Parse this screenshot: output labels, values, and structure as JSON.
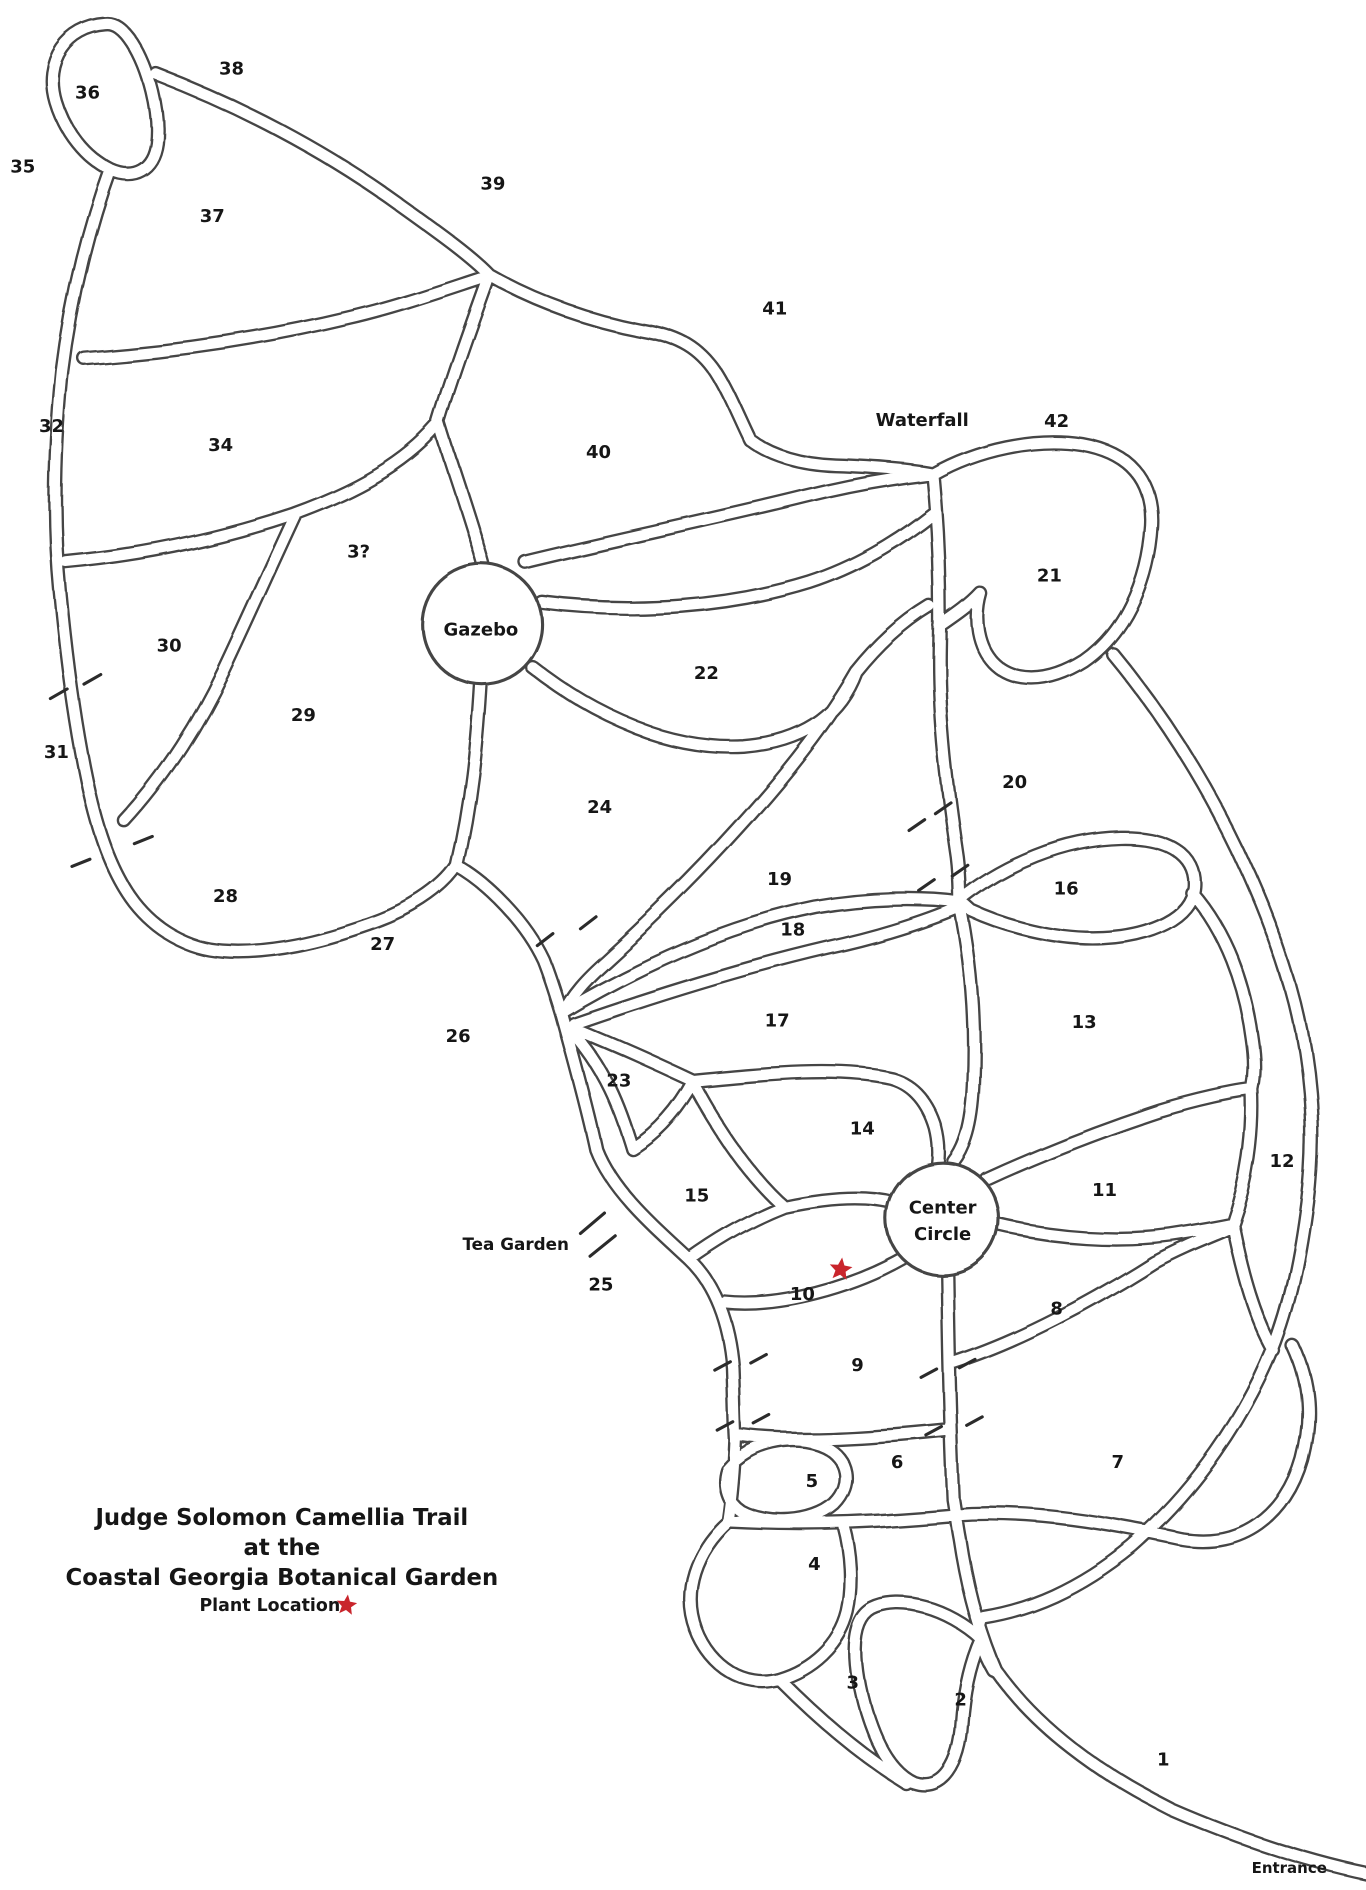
{
  "map": {
    "title_lines": [
      "Judge Solomon Camellia Trail",
      "at the",
      "Coastal Georgia Botanical Garden"
    ],
    "legend": {
      "label": "Plant Location"
    },
    "colors": {
      "ink": "#454545",
      "text": "#161616",
      "star": "#c9252c"
    },
    "regions": [
      {
        "number": "1",
        "x": 970,
        "y": 1467
      },
      {
        "number": "2",
        "x": 801,
        "y": 1417
      },
      {
        "number": "3",
        "x": 711,
        "y": 1403
      },
      {
        "number": "4",
        "x": 679,
        "y": 1304
      },
      {
        "number": "5",
        "x": 677,
        "y": 1235
      },
      {
        "number": "6",
        "x": 748,
        "y": 1219
      },
      {
        "number": "7",
        "x": 932,
        "y": 1219
      },
      {
        "number": "8",
        "x": 881,
        "y": 1091
      },
      {
        "number": "9",
        "x": 715,
        "y": 1138
      },
      {
        "number": "10",
        "x": 669,
        "y": 1079
      },
      {
        "number": "11",
        "x": 921,
        "y": 992
      },
      {
        "number": "12",
        "x": 1069,
        "y": 968
      },
      {
        "number": "13",
        "x": 904,
        "y": 852
      },
      {
        "number": "14",
        "x": 719,
        "y": 941
      },
      {
        "number": "15",
        "x": 581,
        "y": 997
      },
      {
        "number": "16",
        "x": 889,
        "y": 741
      },
      {
        "number": "17",
        "x": 648,
        "y": 851
      },
      {
        "number": "18",
        "x": 661,
        "y": 775
      },
      {
        "number": "19",
        "x": 650,
        "y": 733
      },
      {
        "number": "20",
        "x": 846,
        "y": 652
      },
      {
        "number": "21",
        "x": 875,
        "y": 480
      },
      {
        "number": "22",
        "x": 589,
        "y": 561
      },
      {
        "number": "23",
        "x": 516,
        "y": 901
      },
      {
        "number": "24",
        "x": 500,
        "y": 673
      },
      {
        "number": "25",
        "x": 501,
        "y": 1071
      },
      {
        "number": "26",
        "x": 382,
        "y": 864
      },
      {
        "number": "27",
        "x": 319,
        "y": 787
      },
      {
        "number": "28",
        "x": 188,
        "y": 747
      },
      {
        "number": "29",
        "x": 253,
        "y": 596
      },
      {
        "number": "30",
        "x": 141,
        "y": 538
      },
      {
        "number": "31",
        "x": 47,
        "y": 627
      },
      {
        "number": "32",
        "x": 43,
        "y": 355
      },
      {
        "number": "3?",
        "x": 299,
        "y": 460
      },
      {
        "number": "34",
        "x": 184,
        "y": 371
      },
      {
        "number": "35",
        "x": 19,
        "y": 139
      },
      {
        "number": "36",
        "x": 73,
        "y": 77
      },
      {
        "number": "37",
        "x": 177,
        "y": 180
      },
      {
        "number": "38",
        "x": 193,
        "y": 57
      },
      {
        "number": "39",
        "x": 411,
        "y": 153
      },
      {
        "number": "40",
        "x": 499,
        "y": 377
      },
      {
        "number": "41",
        "x": 646,
        "y": 257
      },
      {
        "number": "42",
        "x": 881,
        "y": 351
      }
    ],
    "features": [
      {
        "name": "waterfall",
        "lines": [
          "Waterfall"
        ],
        "x": 769,
        "y": 350,
        "fs": 15
      },
      {
        "name": "gazebo",
        "lines": [
          "Gazebo"
        ],
        "x": 401,
        "y": 525,
        "fs": 15
      },
      {
        "name": "center-circle",
        "lines": [
          "Center",
          "Circle"
        ],
        "x": 786,
        "y": 1007,
        "fs": 15
      },
      {
        "name": "tea-garden",
        "lines": [
          "Tea Garden"
        ],
        "x": 430,
        "y": 1037,
        "fs": 14
      },
      {
        "name": "entrance",
        "lines": [
          "Entrance"
        ],
        "x": 1075,
        "y": 1557,
        "fs": 12.5
      }
    ],
    "plant_location": {
      "x": 701,
      "y": 1058,
      "size": 10
    },
    "legend_star": {
      "x": 289,
      "y": 1338,
      "size": 9
    }
  }
}
